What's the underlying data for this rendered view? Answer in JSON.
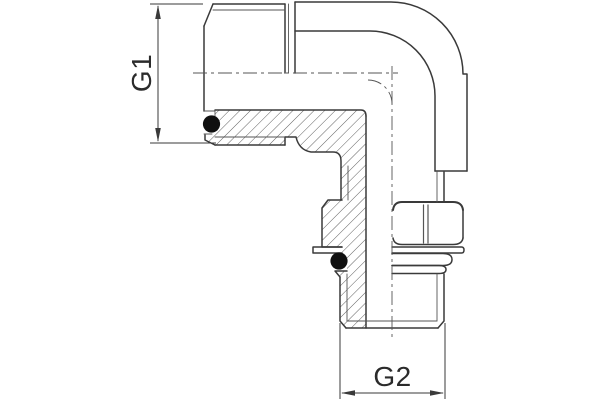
{
  "drawing": {
    "type": "technical-drawing",
    "subject": "90-degree adjustable elbow fitting, half-section view",
    "labels": {
      "g1": "G1",
      "g2": "G2"
    },
    "colors": {
      "outline": "#3a3a3a",
      "thin": "#555555",
      "centerline": "#555555",
      "hatch": "#4f4f4f",
      "o_ring": "#101010",
      "dimension": "#3a3a3a",
      "text": "#2b2b2b",
      "background": "#ffffff"
    },
    "parts": [
      "male-port-g1",
      "elbow-body",
      "male-stud-g2",
      "lock-nut",
      "washer",
      "face-o-ring-seal",
      "stud-o-ring-seal"
    ]
  }
}
